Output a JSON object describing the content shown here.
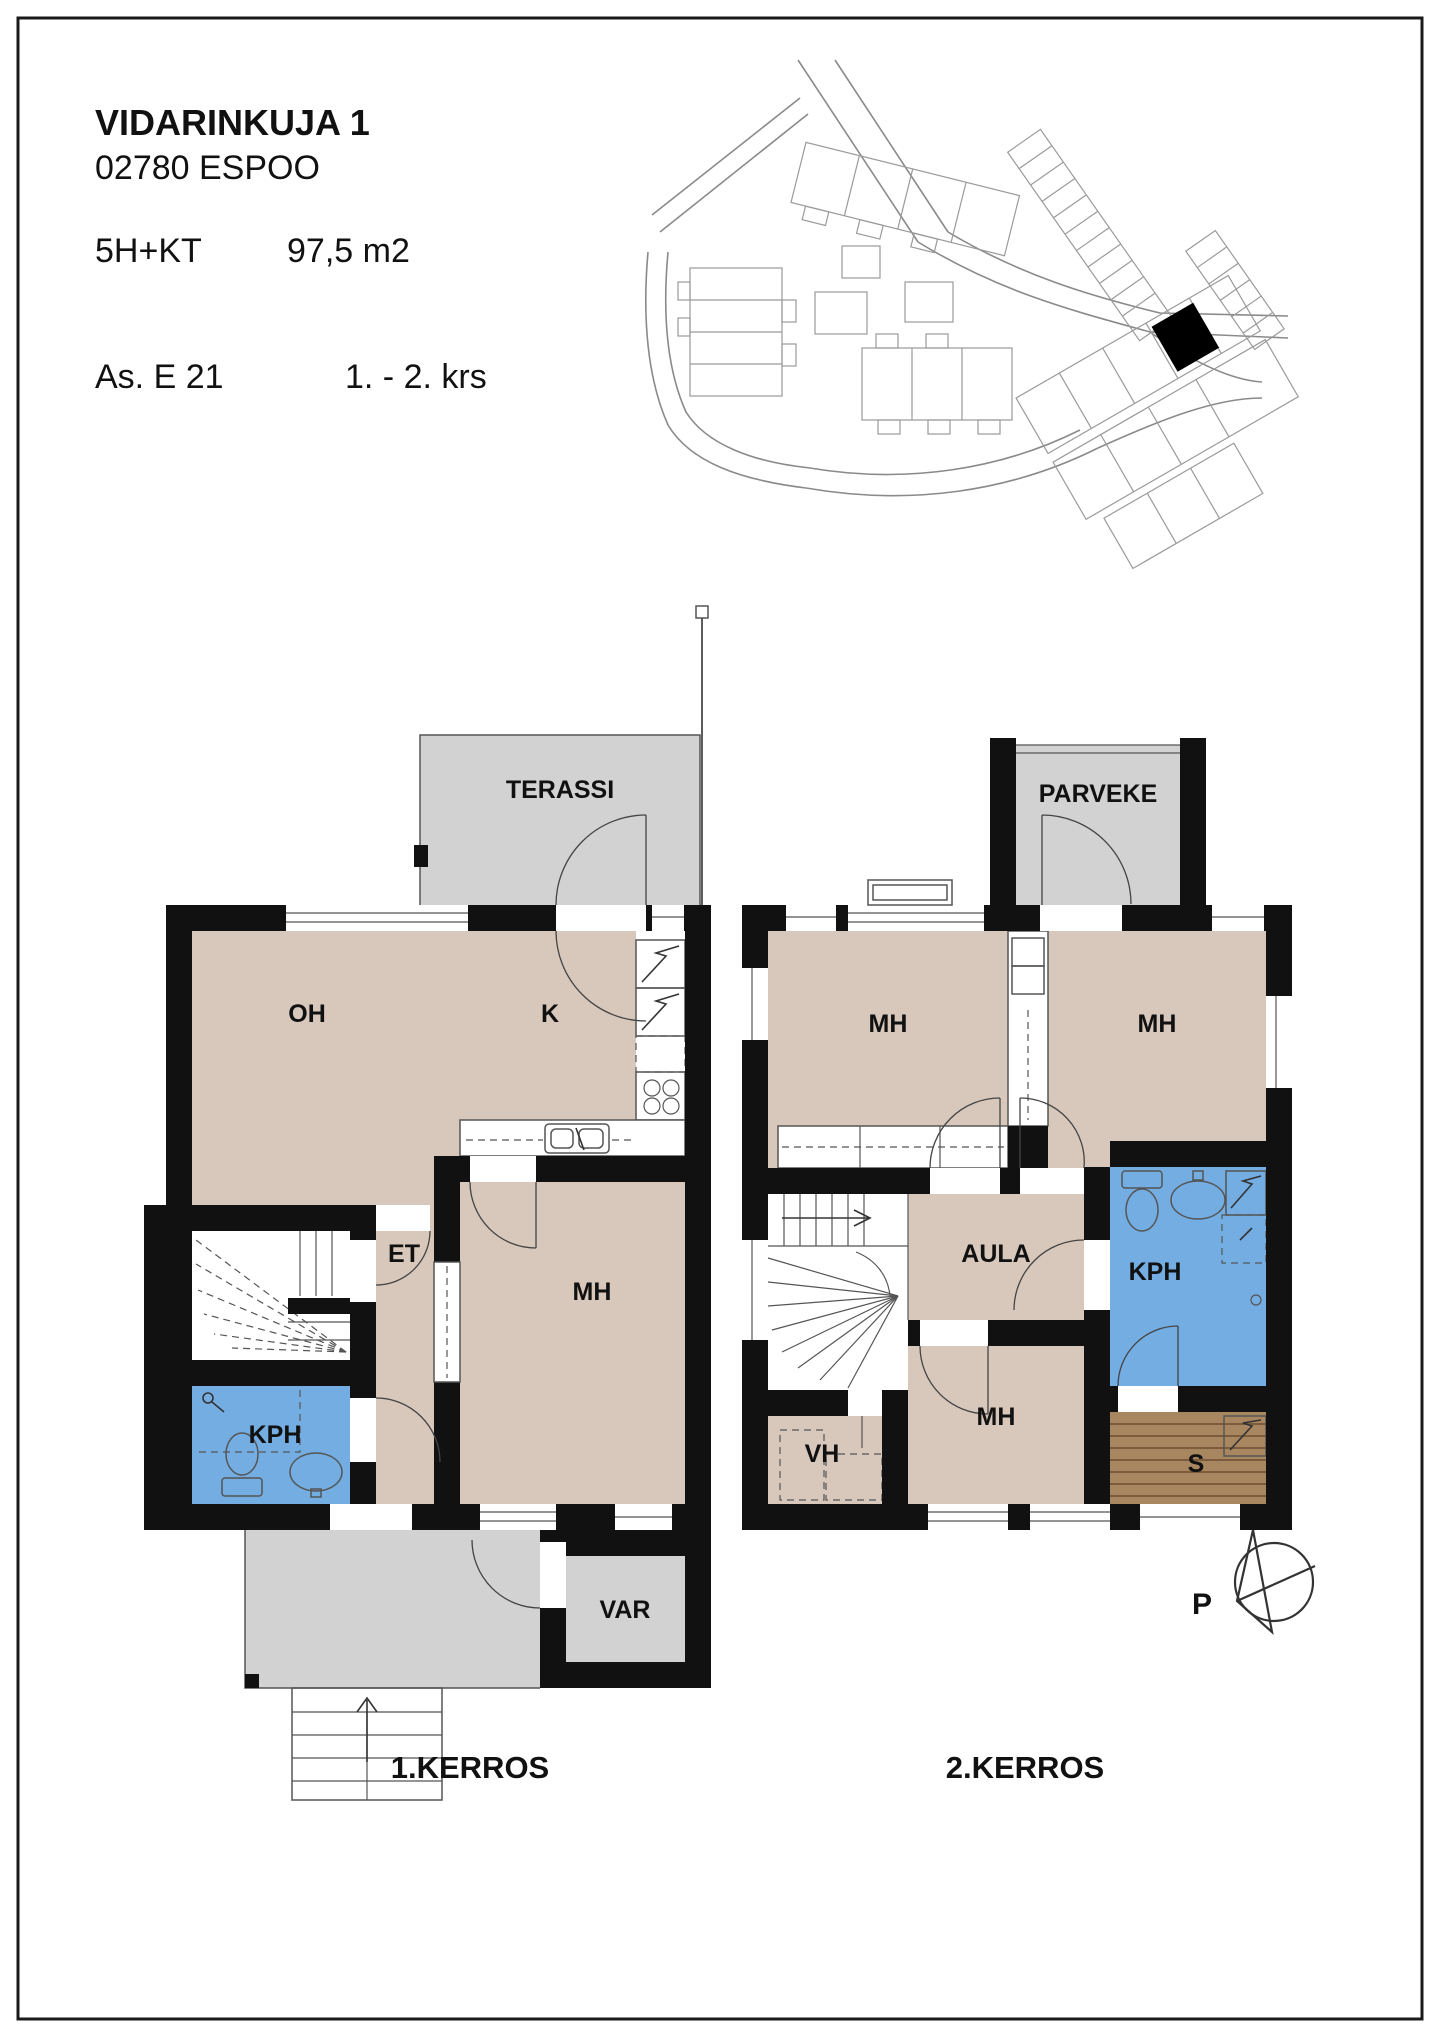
{
  "header": {
    "street": "VIDARINKUJA 1",
    "city": "02780 ESPOO",
    "apartment_type": "5H+KT",
    "area": "97,5 m2",
    "apartment_id": "As. E 21",
    "floors_range": "1. - 2. krs"
  },
  "floor1": {
    "caption": "1.KERROS",
    "terrace": "TERASSI",
    "living_room": "OH",
    "kitchen": "K",
    "hall": "ET",
    "bedroom": "MH",
    "bathroom": "KPH",
    "storage": "VAR"
  },
  "floor2": {
    "caption": "2.KERROS",
    "balcony": "PARVEKE",
    "bedroom_left": "MH",
    "bedroom_right": "MH",
    "landing": "AULA",
    "bathroom": "KPH",
    "bedroom_bottom": "MH",
    "walkin_closet": "VH",
    "sauna": "S"
  },
  "compass": {
    "north": "P"
  },
  "colors": {
    "wall": "#111111",
    "room_floor": "#d8c8bc",
    "wet_room_floor": "#74ade2",
    "outdoor_floor": "#d2d2d2",
    "sauna_floor": "#a8865f",
    "highlighted_unit": "#000000"
  }
}
